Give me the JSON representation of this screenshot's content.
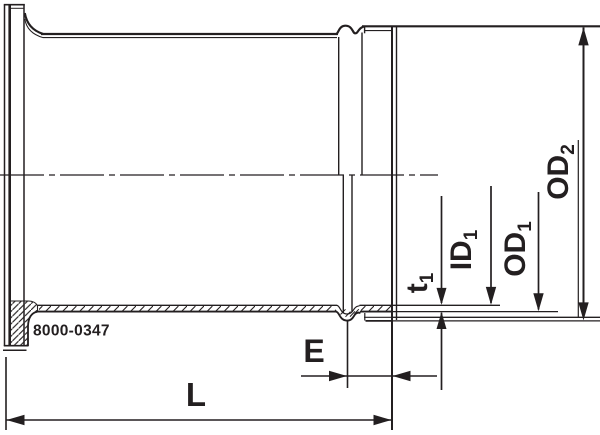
{
  "drawing": {
    "part_number": "8000-0347",
    "line_color": "#231f20",
    "background_color": "#ffffff",
    "labels": {
      "length": "L",
      "end_extension": "E",
      "wall_thickness_base": "t",
      "wall_thickness_sub": "1",
      "inner_diameter_1_base": "ID",
      "inner_diameter_1_sub": "1",
      "outer_diameter_1_base": "OD",
      "outer_diameter_1_sub": "1",
      "outer_diameter_2_base": "OD",
      "outer_diameter_2_sub": "2"
    }
  }
}
